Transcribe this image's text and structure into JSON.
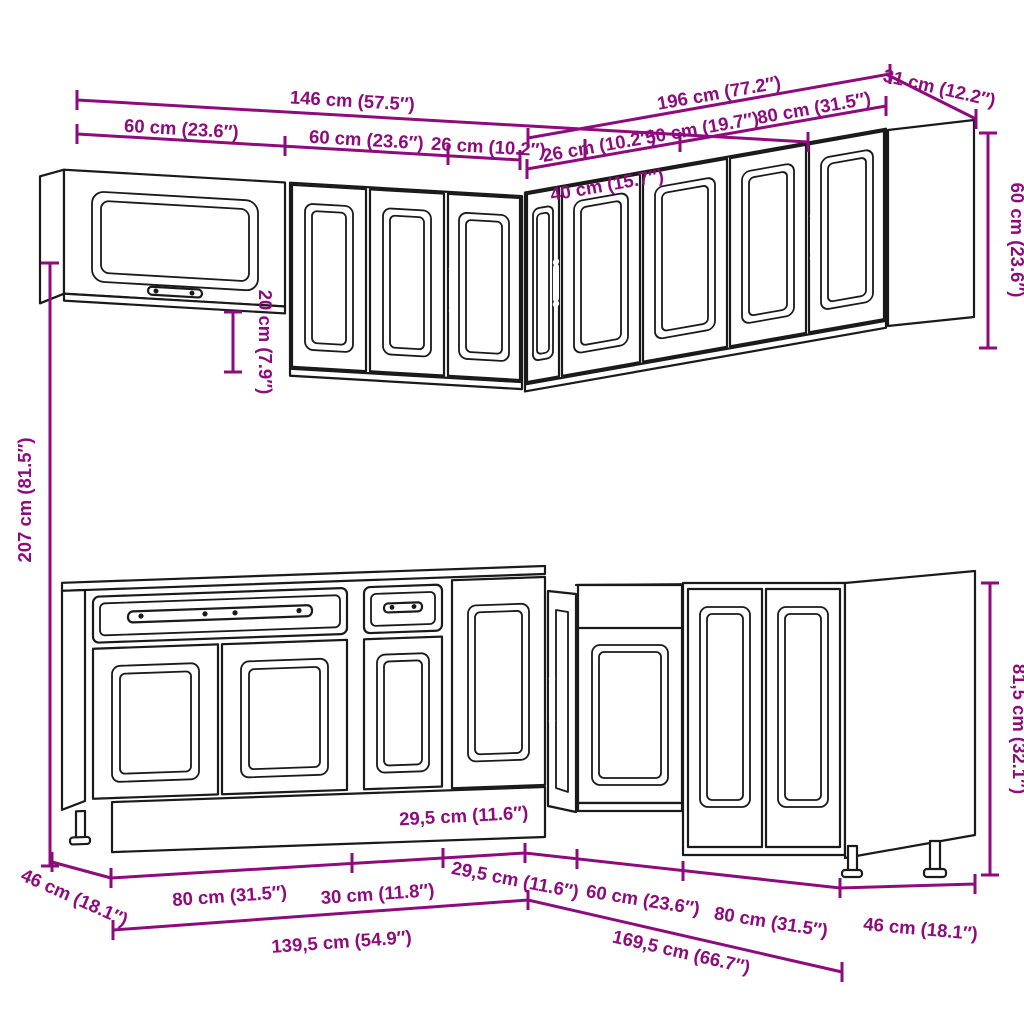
{
  "title": "L-shaped kitchen cabinet set technical drawing",
  "colors": {
    "dimension": "#8E0B7E",
    "line": "#1A1A1A",
    "background": "#FFFFFF"
  },
  "dimensions": {
    "wall": {
      "total_left": "146 cm (57.5″)",
      "total_right": "196 cm (77.2″)",
      "return_right": "31 cm (12.2″)",
      "segments_left": [
        "60 cm (23.6″)",
        "60 cm (23.6″)",
        "26 cm (10.2″)"
      ],
      "segments_right": [
        "26 cm (10.2″)",
        "50 cm (19.7″)",
        "80 cm (31.5″)"
      ],
      "corner_front": "40 cm (15.7″)",
      "height": "60 cm (23.6″)",
      "height_step": "20 cm (7.9″)"
    },
    "overall_height": "207 cm (81.5″)",
    "base": {
      "height": "81,5 cm (32.1″)",
      "segments_left": [
        "80 cm (31.5″)",
        "30 cm (11.8″)"
      ],
      "corner_segment_left": "29,5 cm (11.6″)",
      "corner_segment_right": "29,5 cm (11.6″)",
      "segments_right": [
        "60 cm (23.6″)",
        "80 cm (31.5″)"
      ],
      "depth_left": "46 cm (18.1″)",
      "depth_right": "46 cm (18.1″)",
      "total_left": "139,5 cm (54.9″)",
      "total_right": "169,5 cm (66.7″)"
    }
  }
}
